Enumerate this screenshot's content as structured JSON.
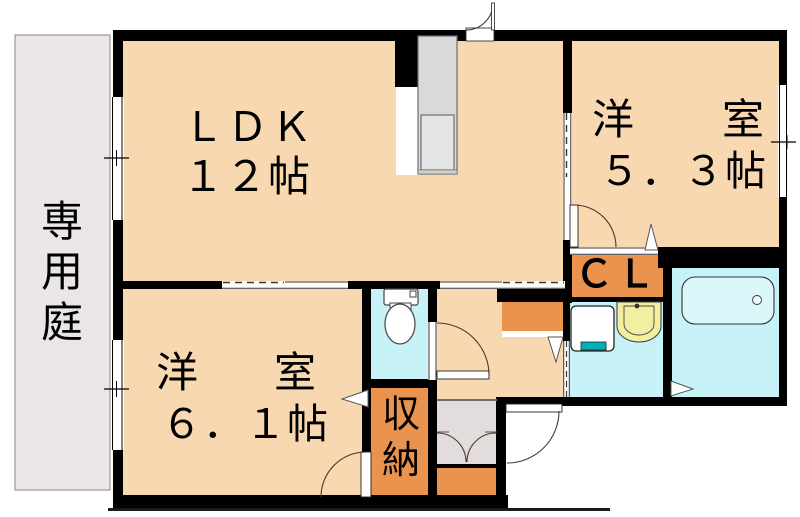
{
  "title": "apartment-floor-plan",
  "rooms": {
    "ldk": {
      "label": "ＬＤＫ",
      "size": "１２帖"
    },
    "western_room_5_3": {
      "label": "洋　室",
      "size": "５．３帖"
    },
    "western_room_6_1": {
      "label": "洋　室",
      "size": "６．１帖"
    },
    "closet": {
      "label": "ＣＬ"
    },
    "storage": {
      "label": "収納"
    },
    "private_garden": {
      "label": "専用庭"
    }
  },
  "fixtures": {
    "kitchen": "kitchen-counter",
    "toilet": "toilet",
    "washer": "washing-machine",
    "basin": "washbasin",
    "bath": "bathtub"
  },
  "colors": {
    "floor_peach": "#F8D8B0",
    "wet_area_cyan": "#C6F2F8",
    "bathtub_fill": "#DBF7FA",
    "storage_orange": "#E9934E",
    "garden_gray": "#EAE6E5",
    "entry_gray": "#E2DDDC",
    "kitchen_gray": "#D9D9D9",
    "basin_yellow": "#F2EFA3",
    "washer_teal": "#00AFBC",
    "wall_black": "#000000"
  }
}
